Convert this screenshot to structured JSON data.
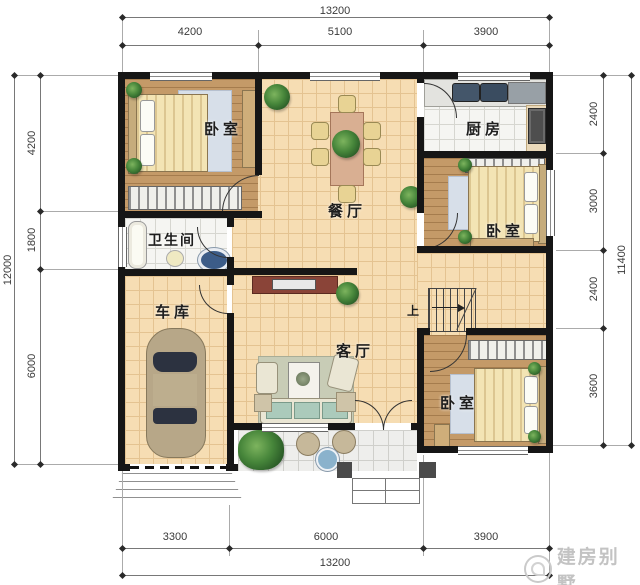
{
  "rooms": {
    "bedroom_nw": {
      "label": "卧室"
    },
    "kitchen": {
      "label": "厨房"
    },
    "dining": {
      "label": "餐厅"
    },
    "bedroom_e": {
      "label": "卧室"
    },
    "bathroom": {
      "label": "卫生间"
    },
    "garage": {
      "label": "车库"
    },
    "living": {
      "label": "客厅"
    },
    "bedroom_se": {
      "label": "卧室"
    },
    "stairs": {
      "label": "上"
    }
  },
  "dimensions": {
    "top": {
      "overall": "13200",
      "segments": [
        "4200",
        "5100",
        "3900"
      ]
    },
    "bottom": {
      "overall": "13200",
      "segments": [
        "3300",
        "6000",
        "3900"
      ]
    },
    "left": {
      "overall": "12000",
      "segments": [
        "4200",
        "1800",
        "6000"
      ]
    },
    "right": {
      "overall": "11400",
      "segments": [
        "2400",
        "3000",
        "2400",
        "3600"
      ]
    }
  },
  "watermark": {
    "text": "建房别墅"
  },
  "colors": {
    "wall": "#161616",
    "tile_floor": "#f6ddb3",
    "wood_floor": "#c49a68",
    "light_floor": "#f5f5f2",
    "plant": "#46853a",
    "water_glass": "#8ab2cc",
    "dimension_text": "#3a3a3a",
    "watermark_text": "#c3c3c3"
  }
}
